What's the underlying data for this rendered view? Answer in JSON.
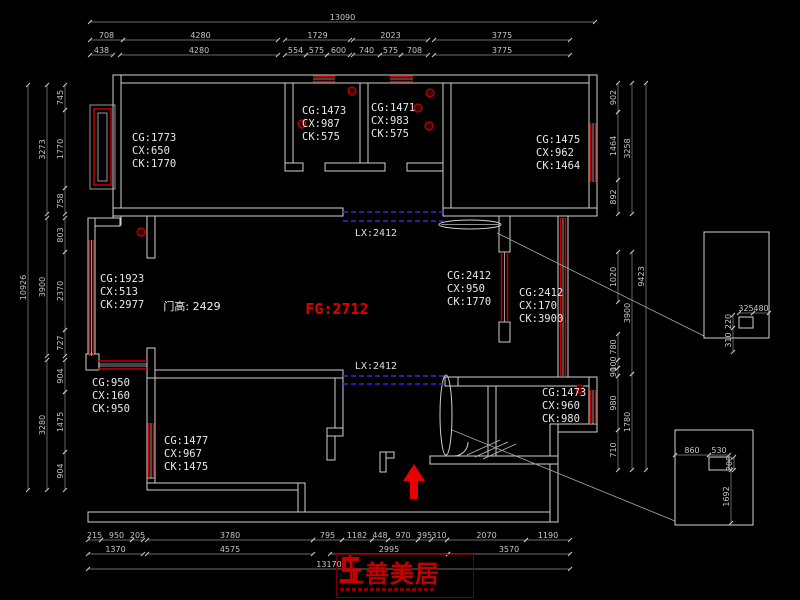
{
  "colors": {
    "background": "#000000",
    "wall_line": "#cfcfcf",
    "window_red": "#c80000",
    "dashed_blue": "#2a2ae6",
    "dimension_text": "#c6c6c6",
    "accent_red": "#e00000",
    "logo_red": "#c40000"
  },
  "labels": {
    "fg": "FG:2712",
    "door_height": "门高: 2429",
    "lx_top": "LX:2412",
    "lx_bottom": "LX:2412"
  },
  "logo": {
    "text": "上善美居"
  },
  "room_annotations": [
    {
      "x": 132,
      "y": 141,
      "lines": [
        "CG:1773",
        "CX:650",
        "CK:1770"
      ]
    },
    {
      "x": 302,
      "y": 114,
      "lines": [
        "CG:1473",
        "CX:987",
        "CK:575"
      ]
    },
    {
      "x": 371,
      "y": 111,
      "lines": [
        "CG:1471",
        "CX:983",
        "CK:575"
      ]
    },
    {
      "x": 536,
      "y": 143,
      "lines": [
        "CG:1475",
        "CX:962",
        "CK:1464"
      ]
    },
    {
      "x": 100,
      "y": 282,
      "lines": [
        "CG:1923",
        "CX:513",
        "CK:2977"
      ]
    },
    {
      "x": 447,
      "y": 279,
      "lines": [
        "CG:2412",
        "CX:950",
        "CK:1770"
      ]
    },
    {
      "x": 519,
      "y": 296,
      "lines": [
        "CG:2412",
        "CX:170",
        "CK:3900"
      ]
    },
    {
      "x": 92,
      "y": 386,
      "lines": [
        "CG:950",
        "CX:160",
        "CK:950"
      ]
    },
    {
      "x": 164,
      "y": 444,
      "lines": [
        "CG:1477",
        "CX:967",
        "CK:1475"
      ]
    },
    {
      "x": 542,
      "y": 396,
      "lines": [
        "CG:1473",
        "CX:960",
        "CK:980"
      ]
    }
  ],
  "dimensions": [
    {
      "t": "13090",
      "x1": 90,
      "y1": 22,
      "x2": 595,
      "y2": 22
    },
    {
      "t": "708",
      "x1": 90,
      "y1": 40,
      "x2": 123,
      "y2": 40
    },
    {
      "t": "4280",
      "x1": 123,
      "y1": 40,
      "x2": 278,
      "y2": 40
    },
    {
      "t": "1729",
      "x1": 285,
      "y1": 40,
      "x2": 350,
      "y2": 40
    },
    {
      "t": "2023",
      "x1": 353,
      "y1": 40,
      "x2": 428,
      "y2": 40
    },
    {
      "t": "3775",
      "x1": 434,
      "y1": 40,
      "x2": 570,
      "y2": 40
    },
    {
      "t": "438",
      "x1": 90,
      "y1": 55,
      "x2": 113,
      "y2": 55
    },
    {
      "t": "4280",
      "x1": 120,
      "y1": 55,
      "x2": 278,
      "y2": 55
    },
    {
      "t": "554",
      "x1": 285,
      "y1": 55,
      "x2": 306,
      "y2": 55
    },
    {
      "t": "575",
      "x1": 306,
      "y1": 55,
      "x2": 327,
      "y2": 55
    },
    {
      "t": "600",
      "x1": 327,
      "y1": 55,
      "x2": 350,
      "y2": 55
    },
    {
      "t": "740",
      "x1": 353,
      "y1": 55,
      "x2": 380,
      "y2": 55
    },
    {
      "t": "575",
      "x1": 380,
      "y1": 55,
      "x2": 401,
      "y2": 55
    },
    {
      "t": "708",
      "x1": 401,
      "y1": 55,
      "x2": 428,
      "y2": 55
    },
    {
      "t": "3775",
      "x1": 434,
      "y1": 55,
      "x2": 570,
      "y2": 55
    },
    {
      "t": "215",
      "x1": 88,
      "y1": 540,
      "x2": 101,
      "y2": 540
    },
    {
      "t": "950",
      "x1": 101,
      "y1": 540,
      "x2": 132,
      "y2": 540
    },
    {
      "t": "205",
      "x1": 132,
      "y1": 540,
      "x2": 143,
      "y2": 540
    },
    {
      "t": "3780",
      "x1": 147,
      "y1": 540,
      "x2": 313,
      "y2": 540
    },
    {
      "t": "795",
      "x1": 313,
      "y1": 540,
      "x2": 342,
      "y2": 540
    },
    {
      "t": "1182",
      "x1": 342,
      "y1": 540,
      "x2": 372,
      "y2": 540
    },
    {
      "t": "448",
      "x1": 372,
      "y1": 540,
      "x2": 388,
      "y2": 540
    },
    {
      "t": "970",
      "x1": 388,
      "y1": 540,
      "x2": 418,
      "y2": 540
    },
    {
      "t": "395",
      "x1": 418,
      "y1": 540,
      "x2": 431,
      "y2": 540
    },
    {
      "t": "310",
      "x1": 431,
      "y1": 540,
      "x2": 447,
      "y2": 540
    },
    {
      "t": "2070",
      "x1": 447,
      "y1": 540,
      "x2": 526,
      "y2": 540
    },
    {
      "t": "1190",
      "x1": 526,
      "y1": 540,
      "x2": 570,
      "y2": 540
    },
    {
      "t": "1370",
      "x1": 88,
      "y1": 554,
      "x2": 143,
      "y2": 554
    },
    {
      "t": "4575",
      "x1": 147,
      "y1": 554,
      "x2": 313,
      "y2": 554
    },
    {
      "t": "2995",
      "x1": 330,
      "y1": 554,
      "x2": 448,
      "y2": 554
    },
    {
      "t": "3570",
      "x1": 448,
      "y1": 554,
      "x2": 570,
      "y2": 554
    },
    {
      "t": "13170",
      "x1": 88,
      "y1": 569,
      "x2": 570,
      "y2": 569
    },
    {
      "t": "745",
      "x1": 65,
      "y1": 85,
      "x2": 65,
      "y2": 110
    },
    {
      "t": "1770",
      "x1": 65,
      "y1": 110,
      "x2": 65,
      "y2": 188
    },
    {
      "t": "758",
      "x1": 65,
      "y1": 188,
      "x2": 65,
      "y2": 214
    },
    {
      "t": "803",
      "x1": 65,
      "y1": 218,
      "x2": 65,
      "y2": 252
    },
    {
      "t": "2370",
      "x1": 65,
      "y1": 252,
      "x2": 65,
      "y2": 330
    },
    {
      "t": "727",
      "x1": 65,
      "y1": 330,
      "x2": 65,
      "y2": 356
    },
    {
      "t": "904",
      "x1": 65,
      "y1": 360,
      "x2": 65,
      "y2": 392
    },
    {
      "t": "1475",
      "x1": 65,
      "y1": 392,
      "x2": 65,
      "y2": 452
    },
    {
      "t": "904",
      "x1": 65,
      "y1": 452,
      "x2": 65,
      "y2": 490
    },
    {
      "t": "3273",
      "x1": 47,
      "y1": 85,
      "x2": 47,
      "y2": 214
    },
    {
      "t": "3900",
      "x1": 47,
      "y1": 218,
      "x2": 47,
      "y2": 356
    },
    {
      "t": "3280",
      "x1": 47,
      "y1": 360,
      "x2": 47,
      "y2": 490
    },
    {
      "t": "10926",
      "x1": 28,
      "y1": 85,
      "x2": 28,
      "y2": 490
    },
    {
      "t": "902",
      "x1": 618,
      "y1": 83,
      "x2": 618,
      "y2": 112
    },
    {
      "t": "1464",
      "x1": 618,
      "y1": 112,
      "x2": 618,
      "y2": 180
    },
    {
      "t": "892",
      "x1": 618,
      "y1": 180,
      "x2": 618,
      "y2": 214
    },
    {
      "t": "1020",
      "x1": 618,
      "y1": 252,
      "x2": 618,
      "y2": 302
    },
    {
      "t": "780",
      "x1": 618,
      "y1": 334,
      "x2": 618,
      "y2": 360
    },
    {
      "t": "100",
      "x1": 618,
      "y1": 360,
      "x2": 618,
      "y2": 368
    },
    {
      "t": "90",
      "x1": 618,
      "y1": 368,
      "x2": 618,
      "y2": 376
    },
    {
      "t": "980",
      "x1": 618,
      "y1": 376,
      "x2": 618,
      "y2": 430
    },
    {
      "t": "710",
      "x1": 618,
      "y1": 430,
      "x2": 618,
      "y2": 470
    },
    {
      "t": "3258",
      "x1": 632,
      "y1": 83,
      "x2": 632,
      "y2": 214
    },
    {
      "t": "3900",
      "x1": 632,
      "y1": 252,
      "x2": 632,
      "y2": 374
    },
    {
      "t": "1780",
      "x1": 632,
      "y1": 374,
      "x2": 632,
      "y2": 470
    },
    {
      "t": "9423",
      "x1": 646,
      "y1": 83,
      "x2": 646,
      "y2": 470
    },
    {
      "t": "325",
      "x1": 739,
      "y1": 313,
      "x2": 753,
      "y2": 313
    },
    {
      "t": "480",
      "x1": 753,
      "y1": 313,
      "x2": 769,
      "y2": 313
    },
    {
      "t": "220",
      "x1": 733,
      "y1": 315,
      "x2": 733,
      "y2": 328
    },
    {
      "t": "310",
      "x1": 733,
      "y1": 328,
      "x2": 733,
      "y2": 352
    },
    {
      "t": "860",
      "x1": 675,
      "y1": 455,
      "x2": 709,
      "y2": 455
    },
    {
      "t": "530",
      "x1": 709,
      "y1": 455,
      "x2": 729,
      "y2": 455
    },
    {
      "t": "200",
      "x1": 734,
      "y1": 457,
      "x2": 734,
      "y2": 470
    },
    {
      "t": "1692",
      "x1": 731,
      "y1": 470,
      "x2": 731,
      "y2": 523
    }
  ]
}
